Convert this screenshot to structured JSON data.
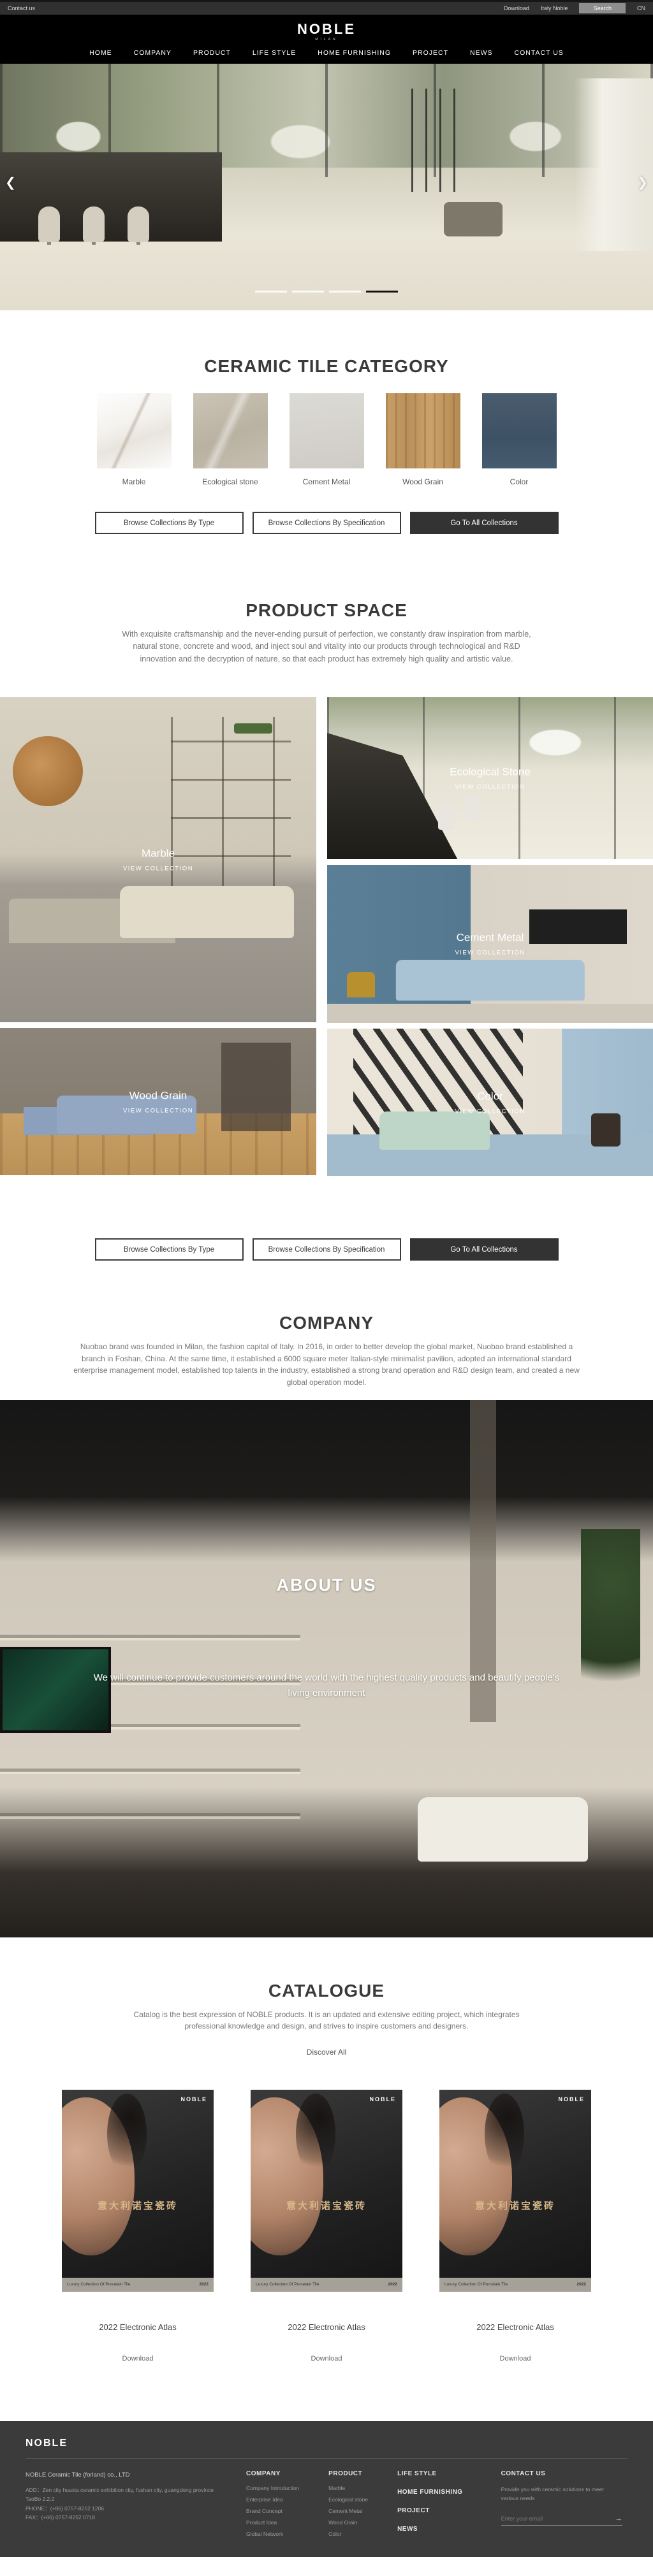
{
  "topbar": {
    "contact": "Contact us",
    "download": "Download",
    "italy": "Italy Noble",
    "search": "Search",
    "lang": "CN"
  },
  "header": {
    "logo": "NOBLE",
    "logo_sub": "MILAN",
    "nav": [
      "HOME",
      "COMPANY",
      "PRODUCT",
      "LIFE STYLE",
      "HOME FURNISHING",
      "PROJECT",
      "NEWS",
      "CONTACT US"
    ]
  },
  "hero": {
    "prev": "❮",
    "next": "❯"
  },
  "category": {
    "title": "CERAMIC TILE CATEGORY",
    "items": [
      {
        "label": "Marble"
      },
      {
        "label": "Ecological stone"
      },
      {
        "label": "Cement Metal"
      },
      {
        "label": "Wood Grain"
      },
      {
        "label": "Color"
      }
    ]
  },
  "collection_buttons": {
    "by_type": "Browse Collections By Type",
    "by_spec": "Browse Collections By Specification",
    "all": "Go To All Collections"
  },
  "product_space": {
    "title": "PRODUCT SPACE",
    "description": "With exquisite craftsmanship and the never-ending pursuit of perfection, we constantly draw inspiration from marble, natural stone, concrete and wood, and inject soul and vitality into our products through technological and R&D innovation and the decryption of nature, so that each product has extremely high quality and artistic value.",
    "tiles": [
      {
        "name": "Marble",
        "cta": "VIEW COLLECTION"
      },
      {
        "name": "Ecological Stone",
        "cta": "VIEW COLLECTION"
      },
      {
        "name": "Cement Metal",
        "cta": "VIEW COLLECTION"
      },
      {
        "name": "Wood Grain",
        "cta": "VIEW COLLECTION"
      },
      {
        "name": "Color",
        "cta": "VIEW COLLECTION"
      }
    ]
  },
  "company": {
    "title": "COMPANY",
    "description": "Nuobao brand was founded in Milan, the fashion capital of Italy. In 2016, in order to better develop the global market, Nuobao brand established a branch in Foshan, China. At the same time, it established a 6000 square meter Italian-style minimalist pavilion, adopted an international standard enterprise management model, established top talents in the industry, established a strong brand operation and R&D design team, and created a new global operation model."
  },
  "about": {
    "title": "ABOUT US",
    "subtitle": "We will continue to provide customers around the world with the highest quality products and beautify people's living environment"
  },
  "catalogue": {
    "title": "CATALOGUE",
    "description": "Catalog is the best expression of NOBLE products. It is an updated and extensive editing project, which integrates professional knowledge and design, and strives to inspire customers and designers.",
    "discover": "Discover All",
    "cover": {
      "brand": "NOBLE",
      "title_cn": "意大利诺宝瓷砖",
      "strip_left": "Luxury Collection Of Porcelain Tile",
      "strip_right": "2022"
    },
    "items": [
      {
        "label": "2022 Electronic Atlas",
        "download": "Download"
      },
      {
        "label": "2022 Electronic Atlas",
        "download": "Download"
      },
      {
        "label": "2022 Electronic Atlas",
        "download": "Download"
      }
    ]
  },
  "footer": {
    "logo": "NOBLE",
    "company_name": "NOBLE Ceramic Tile (forland) co., LTD",
    "address": "ADD：Zen city huaxia ceramic exhibition city, foshan city, guangdong province TaoBo 2.2.2",
    "phone": "PHONE：(+86) 0757-8252 1206",
    "fax": "FAX：(+86) 0757-8252 0718",
    "company_col": {
      "title": "COMPANY",
      "items": [
        "Company Introduction",
        "Enterprise Idea",
        "Brand Concept",
        "Product Idea",
        "Global Network"
      ]
    },
    "product_col": {
      "title": "PRODUCT",
      "items": [
        "Marble",
        "Ecological stone",
        "Cement Metal",
        "Wood Grain",
        "Color"
      ]
    },
    "links": [
      "LIFE STYLE",
      "HOME FURNISHING",
      "PROJECT",
      "NEWS"
    ],
    "contact": {
      "title": "CONTACT US",
      "blurb": "Provide you with ceramic solutions to meet various needs",
      "placeholder": "Enter your email"
    }
  }
}
